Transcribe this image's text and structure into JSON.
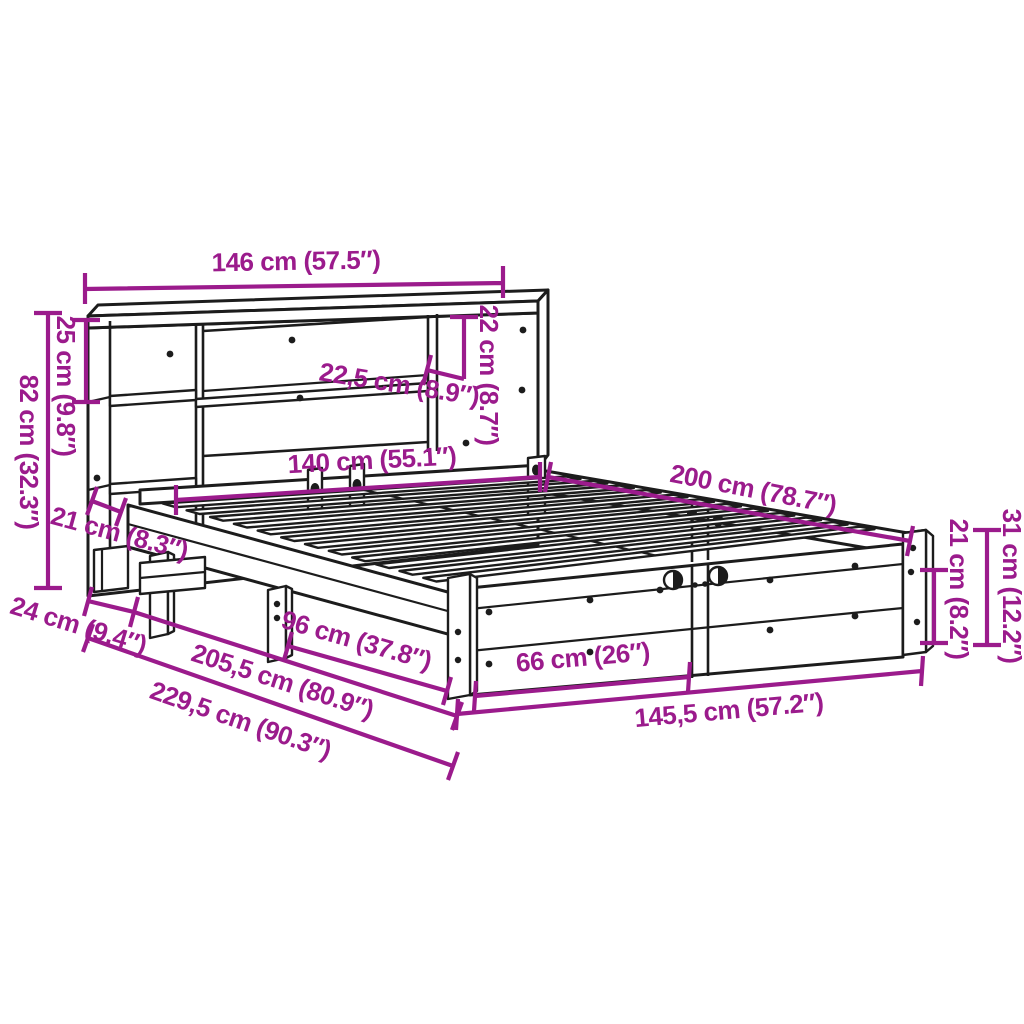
{
  "diagram": {
    "colors": {
      "dimension": "#9B1B8C",
      "outline": "#1C1C1C",
      "background": "#FFFFFF"
    },
    "dimensions": {
      "headboard_width": {
        "label": "146 cm (57.5″)"
      },
      "top_shelf_height": {
        "label": "25 cm (9.8″)"
      },
      "headboard_height": {
        "label": "82 cm (32.3″)"
      },
      "niche_height": {
        "label": "22 cm (8.7″)"
      },
      "shelf_depth": {
        "label": "22,5 cm (8.9″)"
      },
      "bed_width_inner": {
        "label": "140 cm (55.1″)"
      },
      "bed_length_inner": {
        "label": "200 cm (78.7″)"
      },
      "headboard_overhang": {
        "label": "21 cm (8.3″)"
      },
      "headboard_depth": {
        "label": "24 cm (9.4″)"
      },
      "leg_spacing": {
        "label": "96 cm (37.8″)"
      },
      "frame_length": {
        "label": "205,5 cm (80.9″)"
      },
      "total_length": {
        "label": "229,5 cm (90.3″)"
      },
      "foot_panel_segment": {
        "label": "66 cm (26″)"
      },
      "frame_width_outer": {
        "label": "145,5 cm (57.2″)"
      },
      "side_rail_height": {
        "label": "21 cm (8.2″)"
      },
      "frame_height": {
        "label": "31 cm (12.2″)"
      }
    }
  }
}
